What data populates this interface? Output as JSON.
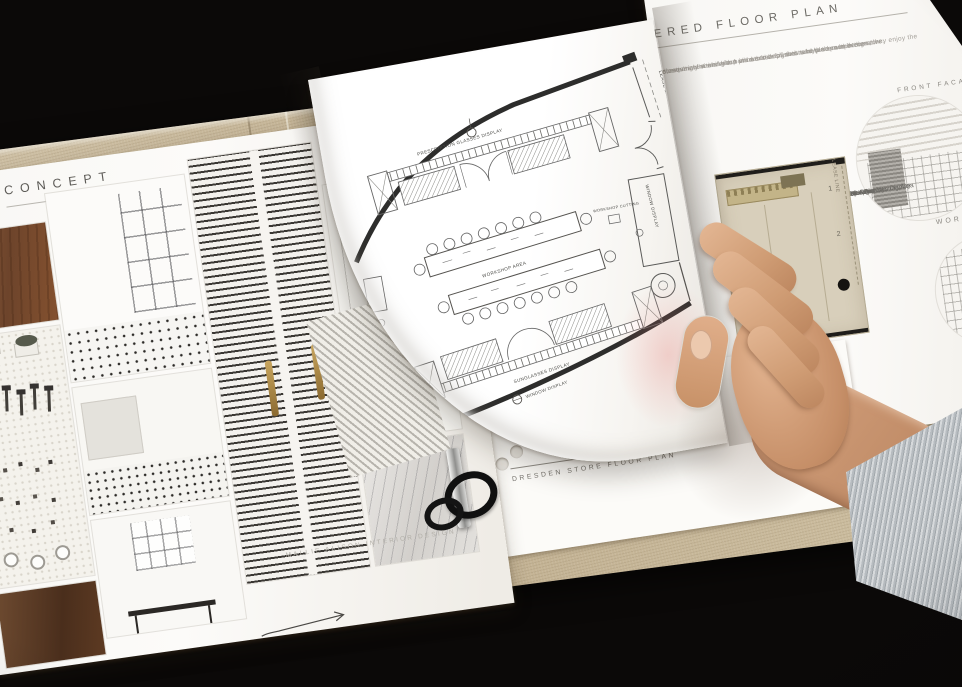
{
  "scene": {
    "type": "photograph",
    "subject": "Interior design portfolio binder opened to a Dresden store floor-plan spread, a hand turning the page",
    "background_color": "#0b0908",
    "cover_color": "#c8b99c",
    "accent_skin": "#cf9c74",
    "sleeve_color": "#b7bcc0"
  },
  "left_page": {
    "title": "CONCEPT",
    "credit": "MALLIE ALISON  INTERIOR DESIGN",
    "photos": [
      "wood-desk",
      "pegboard-tools",
      "glazed-partition",
      "tiled-kitchen",
      "kitchen-window",
      "louvered-panel",
      "white-kitchen",
      "marble-detail",
      "dark-wood-detail"
    ]
  },
  "plan_page": {
    "caption": "DRESDEN STORE  FLOOR PLAN",
    "labels": {
      "prescription": "PRESCRIPTION GLASSES DISPLAY",
      "workshop_area": "WORKSHOP AREA",
      "sunglasses": "SUNGLASSES DISPLAY",
      "window_display_side": "WINDOW DISPLAY",
      "window_display_front": "WINDOW DISPLAY",
      "lease_line": "LEASE LINE",
      "workshop_cutting": "WORKSHOP CUTTING"
    }
  },
  "right_page": {
    "title": "ERED FLOOR PLAN",
    "paragraphs": [
      "creative activities with both a sense of autonomy and competence, they enjoy the",
      "ncreasingly seeking out products designed to help them to be creative",
      "elements of a workshop in both the finishes and the space design",
      "d, experiment and learn via workshops that take place within the store."
    ],
    "front_facade": "FRONT FACADE",
    "workshop": "WORK",
    "legend_title": "LEGEND:",
    "legend": [
      "1. Window Display",
      "2. Entrance",
      "3. Prescription Glasses Display",
      "4. Workshop Area",
      "5. Sunglasses Display",
      "6. Storage & Client Waiting Area",
      "7. Eye Exam Room",
      "8. POS & Storage"
    ],
    "rendered_plan": {
      "n1": "1",
      "n2": "2",
      "lease_line": "LEASE LINE"
    }
  }
}
